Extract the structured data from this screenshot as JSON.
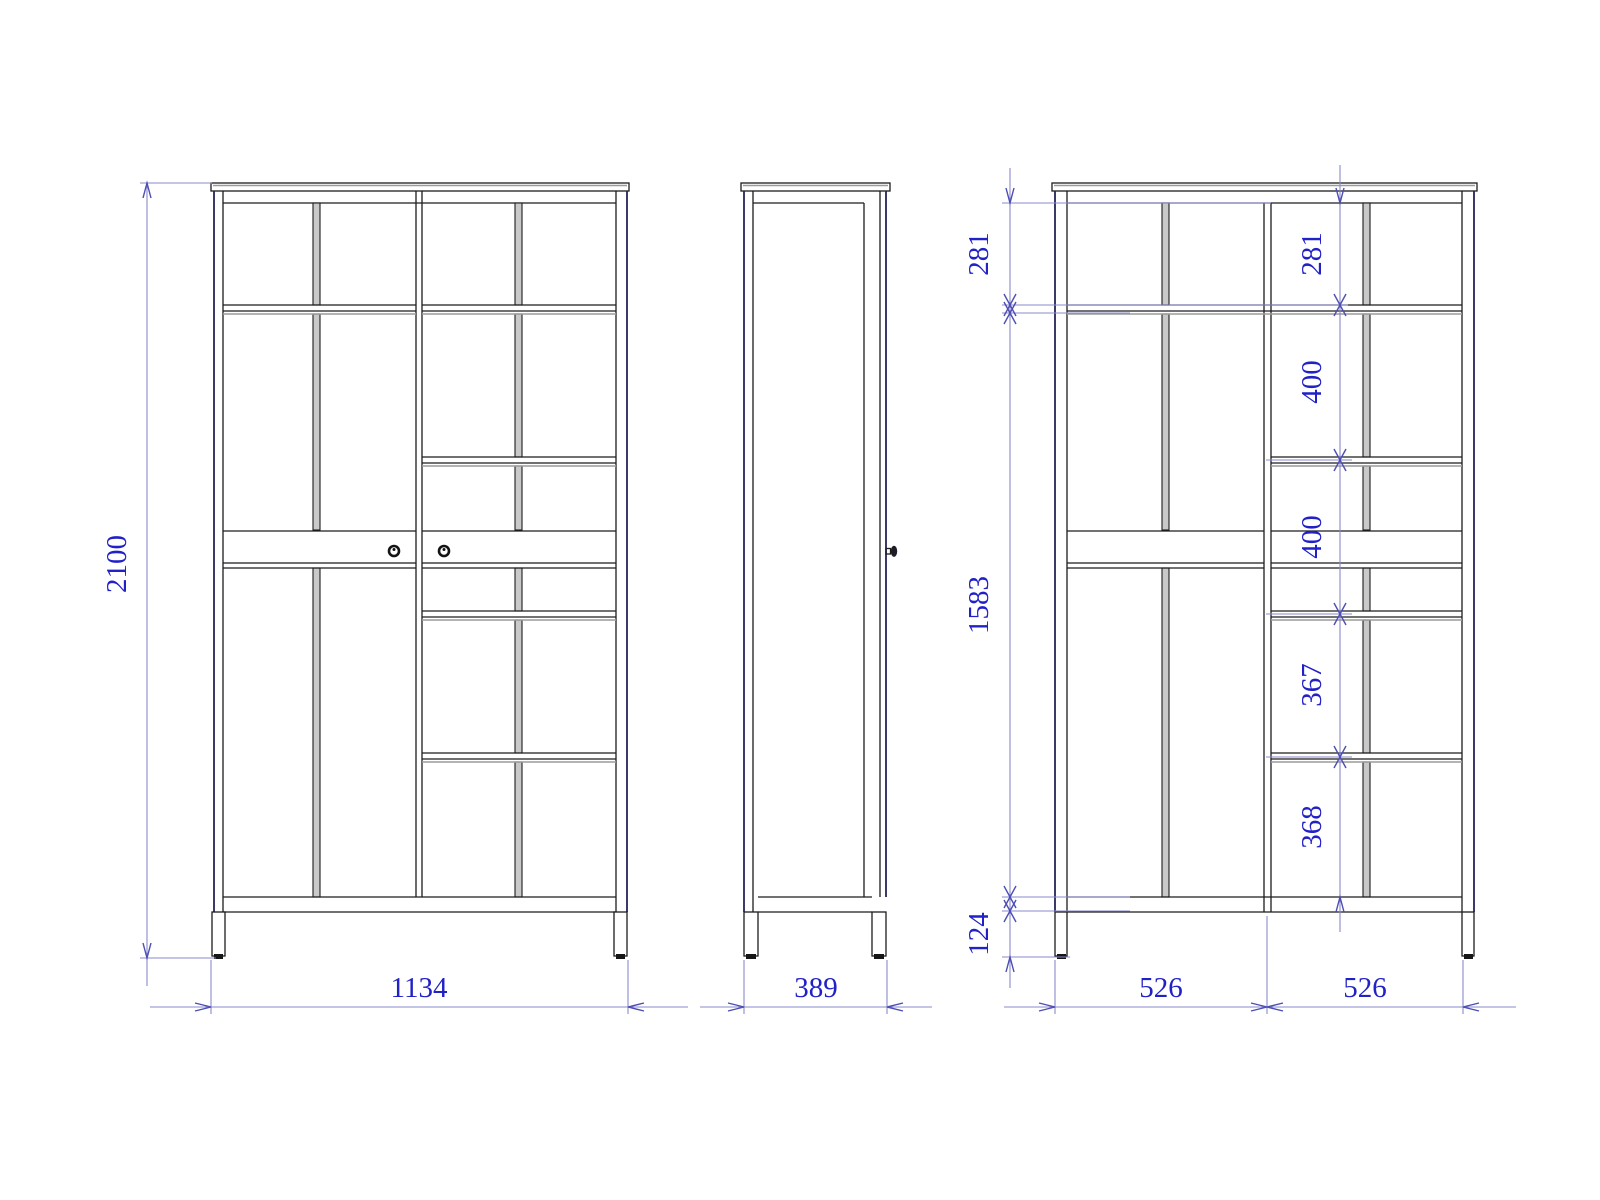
{
  "drawing_type": "wardrobe three-view technical drawing",
  "dimensions": {
    "front_height": "2100",
    "front_width": "1134",
    "side_depth": "389",
    "left_chain": [
      "281",
      "1583",
      "124"
    ],
    "right_chain": [
      "281",
      "400",
      "400",
      "367",
      "368"
    ],
    "bottom_widths": [
      "526",
      "526"
    ]
  },
  "colors": {
    "outline": "#1c1c1c",
    "outer_edge": "#23235a",
    "panel_gray": "#c9c9c9",
    "shadow_gray": "#9b9b9b",
    "dimension_line": "#8a8ace",
    "dimension_arrow": "#4d4db4",
    "dimension_text": "#2121c8",
    "background": "#ffffff"
  }
}
